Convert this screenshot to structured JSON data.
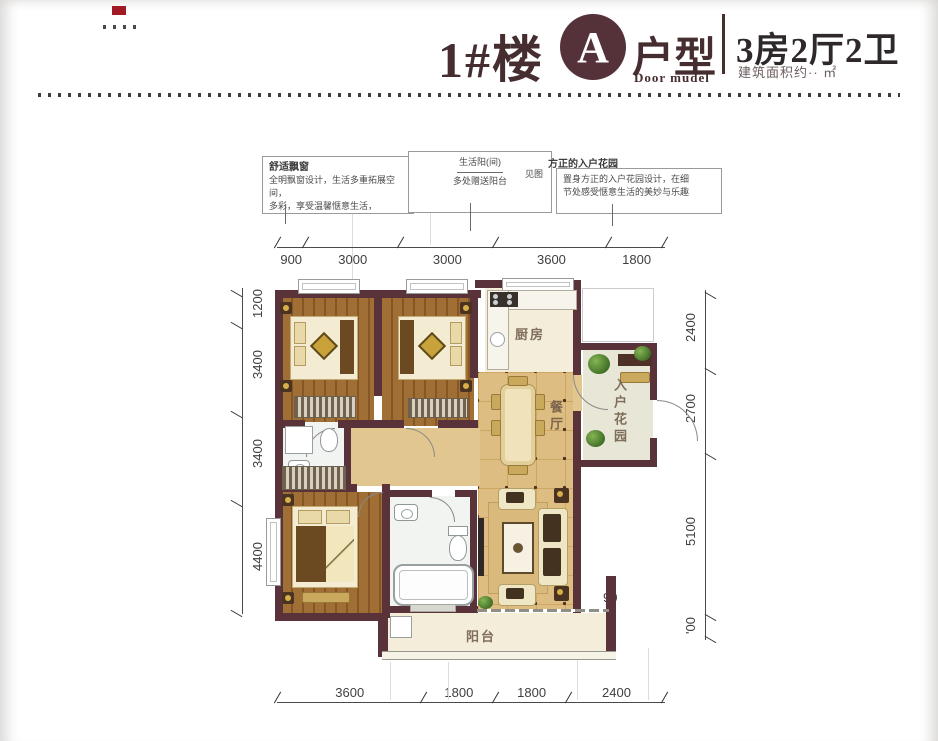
{
  "header": {
    "building": "1#楼",
    "unit_letter": "A",
    "unit_label": "户型",
    "unit_sublabel": "Door mudel",
    "rooms_summary": "3房2厅2卫",
    "area_note": "建筑面积约·· ㎡"
  },
  "callouts": {
    "left": {
      "title": "舒适飘窗",
      "line1": "全明飘窗设计，生活多重拓展空间，",
      "line2": "多彩，享受温馨惬意生活，"
    },
    "middle": {
      "line1": "生活阳(间)",
      "line2": "见图",
      "line3": "多处赠送阳台"
    },
    "right": {
      "title": "方正的入户花园",
      "line1": "置身方正的入户花园设计，在细",
      "line2": "节处感受惬意生活的美妙与乐趣"
    }
  },
  "plan": {
    "room_labels": {
      "kitchen": "厨房",
      "dining": "餐厅",
      "entry_garden": "入户花园",
      "balcony": "阳台"
    }
  },
  "dimensions": {
    "top": [
      "900",
      "3000",
      "3000",
      "3600",
      "1800"
    ],
    "left": [
      "1200",
      "3400",
      "3400",
      "4400"
    ],
    "right": [
      "2400",
      "2700",
      "5100",
      "'00"
    ],
    "bottom": [
      "3600",
      "1800",
      "1800",
      "2400"
    ],
    "stray": "90"
  },
  "colors": {
    "wall": "#59323a",
    "accent": "#462d2f",
    "brand_red": "#a21a24",
    "wood_floor": "#a06f36",
    "tile_floor": "#ddbd82"
  }
}
